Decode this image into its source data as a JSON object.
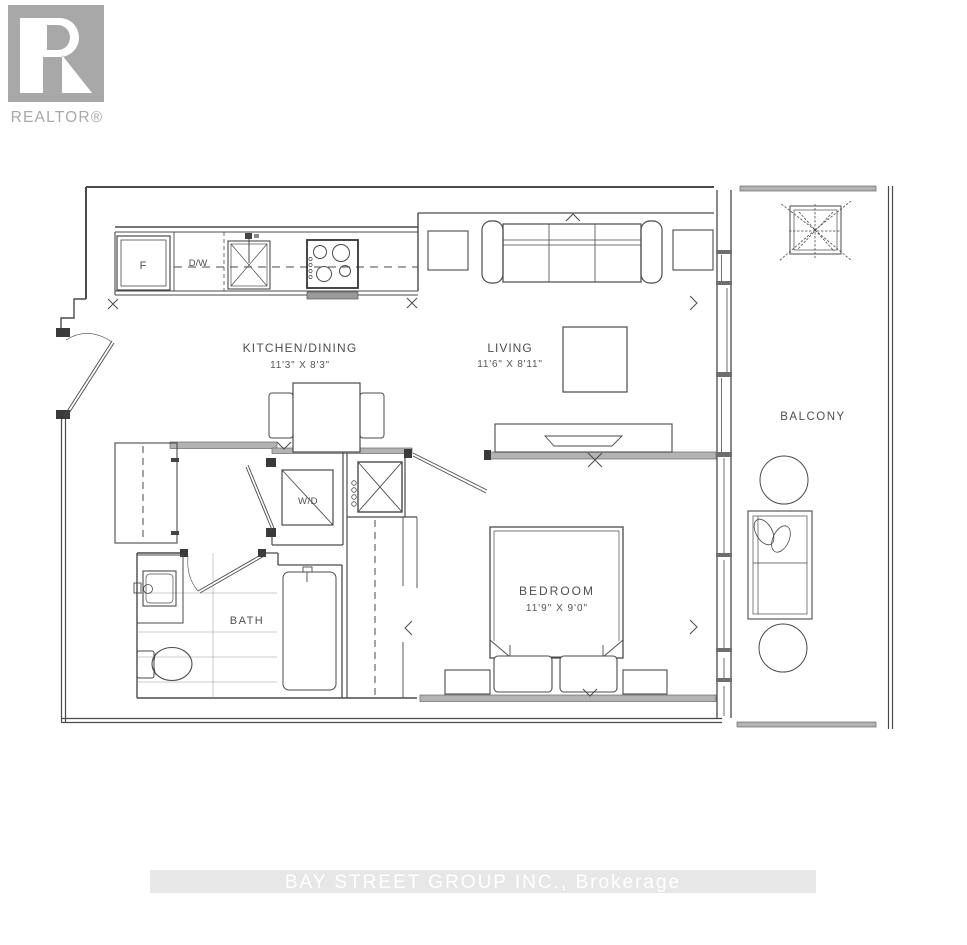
{
  "logo": {
    "wordmark": "REALTOR®"
  },
  "watermark": {
    "text": "BAY STREET GROUP INC., Brokerage"
  },
  "rooms": {
    "kitchen_dining": {
      "name": "KITCHEN/DINING",
      "dims": "11'3\" X 8'3\""
    },
    "living": {
      "name": "LIVING",
      "dims": "11'6\" X 8'11\""
    },
    "bedroom": {
      "name": "BEDROOM",
      "dims": "11'9\" X 9'0\""
    },
    "bath": {
      "name": "BATH"
    },
    "balcony": {
      "name": "BALCONY"
    }
  },
  "labels": {
    "fridge": "F",
    "dishwasher": "D/W",
    "washer_dryer": "W/D"
  },
  "colors": {
    "line": "#4a4a4a",
    "wall_gray": "#b3b3b3",
    "label_text": "#4f4f4f",
    "logo_gray": "#a8a8a8",
    "watermark_band": "#e7e7e7",
    "watermark_text": "#ffffff"
  }
}
